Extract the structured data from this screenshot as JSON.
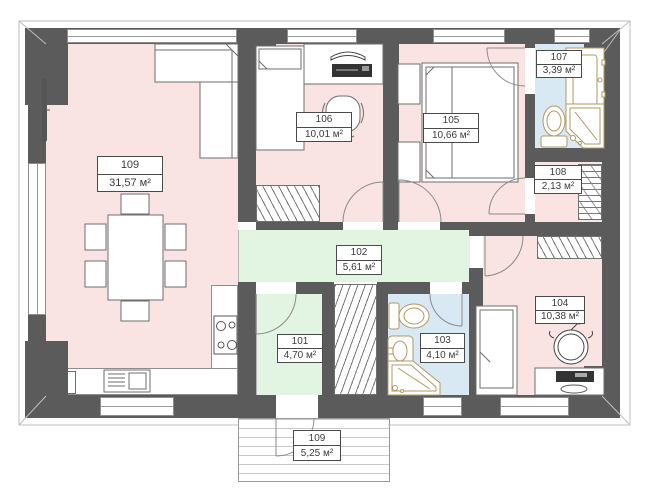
{
  "plan_title": "apartment-floor-plan",
  "rooms": {
    "r109": {
      "number": "109",
      "area": "31,57 м²"
    },
    "r106": {
      "number": "106",
      "area": "10,01 м²"
    },
    "r105": {
      "number": "105",
      "area": "10,66 м²"
    },
    "r107": {
      "number": "107",
      "area": "3,39 м²"
    },
    "r108": {
      "number": "108",
      "area": "2,13 м²"
    },
    "r102": {
      "number": "102",
      "area": "5,61 м²"
    },
    "r101": {
      "number": "101",
      "area": "4,70 м²"
    },
    "r103": {
      "number": "103",
      "area": "4,10 м²"
    },
    "r104": {
      "number": "104",
      "area": "10,38 м²"
    },
    "porch": {
      "number": "109",
      "area": "5,25 м²"
    }
  },
  "kitchen": {
    "x_marker": "x"
  },
  "colors": {
    "wall": "#5b5b5b",
    "room_pink": "#f9e3e3",
    "room_green": "#e2f4e2",
    "room_blue": "#d9e9f4",
    "fixture_tan": "#b09a62",
    "hatch": "#777777"
  }
}
